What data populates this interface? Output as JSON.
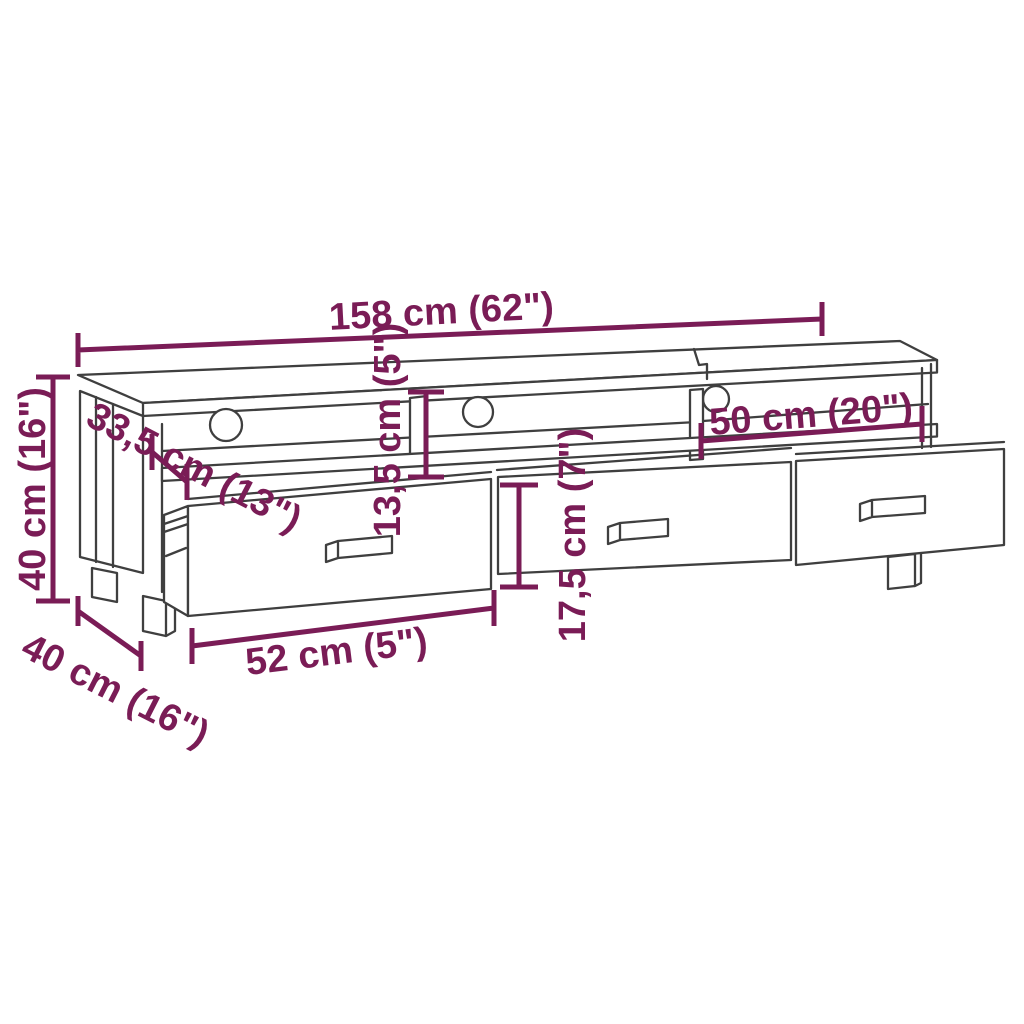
{
  "diagram": {
    "subject": "TV stand technical line drawing with dimensions",
    "colors": {
      "background": "#ffffff",
      "line": "#3f3f3f",
      "accent": "#7a1c56"
    },
    "dimensions": {
      "overall_width": "158 cm (62\")",
      "top_depth": "33,5 cm (13\")",
      "height": "40 cm (16\")",
      "base_depth": "40 cm (16\")",
      "drawer_width": "52 cm (5\")",
      "compartment_height": "13,5 cm (5\")",
      "drawer_height": "17,5 cm (7\")",
      "compartment_width": "50 cm (20\")"
    }
  }
}
